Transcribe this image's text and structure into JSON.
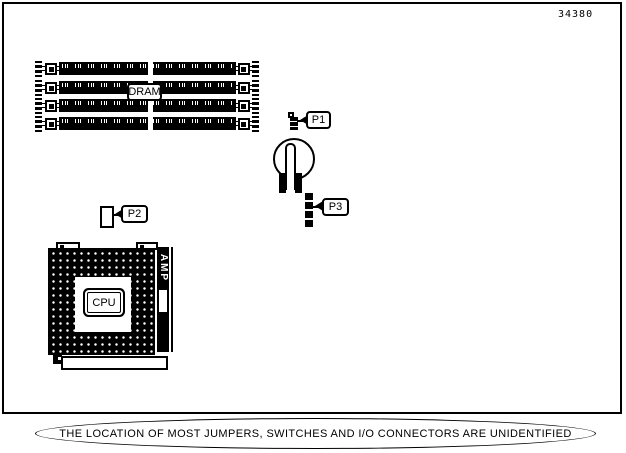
{
  "figure": {
    "number": "34380",
    "caption": "THE LOCATION OF MOST JUMPERS, SWITCHES AND I/O CONNECTORS ARE UNIDENTIFIED"
  },
  "components": {
    "dram": {
      "label": "DRAM",
      "module_count": 4
    },
    "cpu": {
      "label": "CPU"
    },
    "socket_brand": {
      "label": "AMP"
    },
    "jumpers": [
      {
        "id": "p1",
        "label": "P1"
      },
      {
        "id": "p2",
        "label": "P2"
      },
      {
        "id": "p3",
        "label": "P3"
      }
    ]
  },
  "colors": {
    "ink": "#000000",
    "background": "#ffffff"
  }
}
